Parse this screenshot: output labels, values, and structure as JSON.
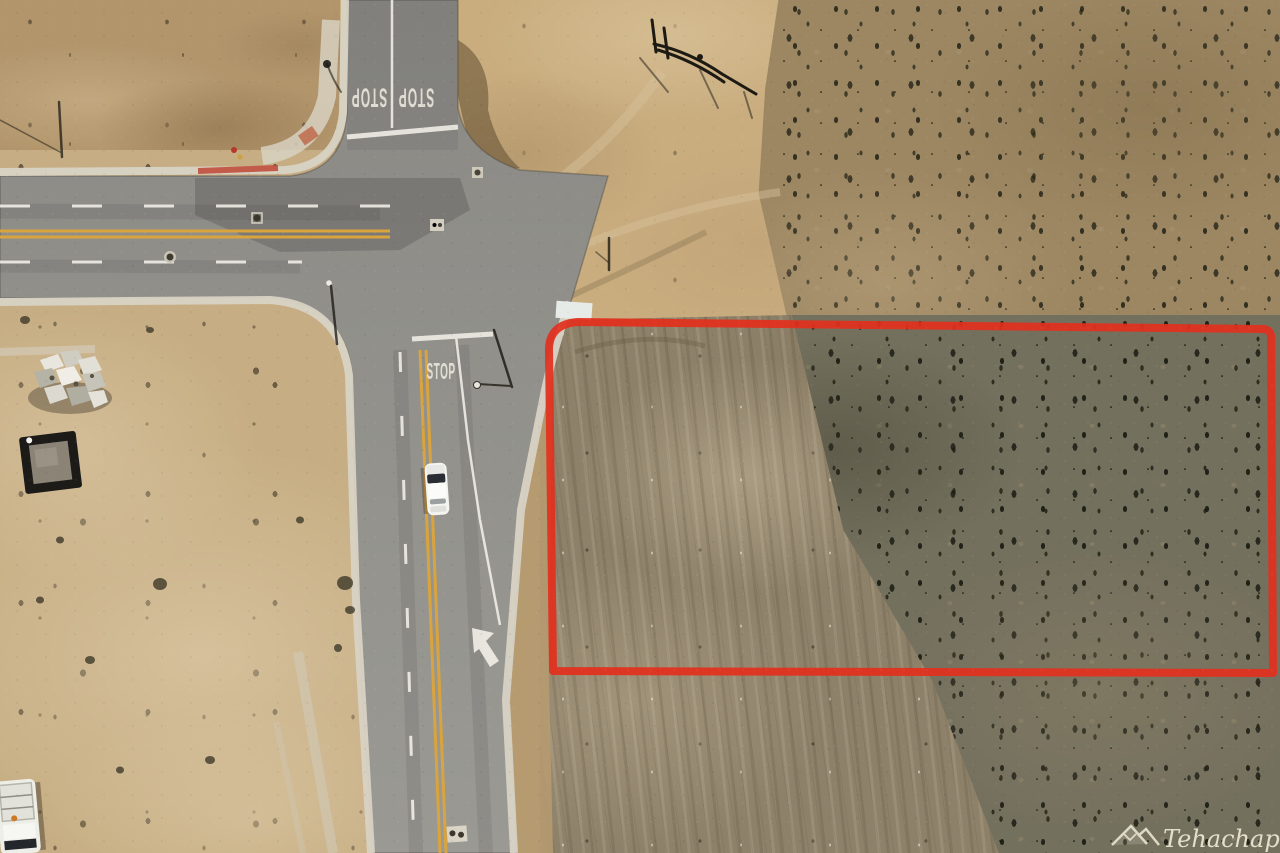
{
  "scene": {
    "kind": "aerial-drone-photo",
    "subject": "Vacant desert land parcel outlined in red at a paved road intersection"
  },
  "road": {
    "stop_marking": "STOP"
  },
  "boundary": {
    "color": "#e2301e"
  },
  "watermark": {
    "icon": "mountain-logo-icon",
    "script": "Tehachapi",
    "caps": "MLS",
    "color": "#e9e5d2"
  },
  "palette": {
    "asphalt": "#8f8e89",
    "concrete_curb": "#d8d3c5",
    "lane_yellow": "#d9a43e",
    "marking_white": "#efede5",
    "desert_light": "#c6ad83",
    "desert_scrub": "#74705e",
    "tilled_field": "#8e8169"
  }
}
